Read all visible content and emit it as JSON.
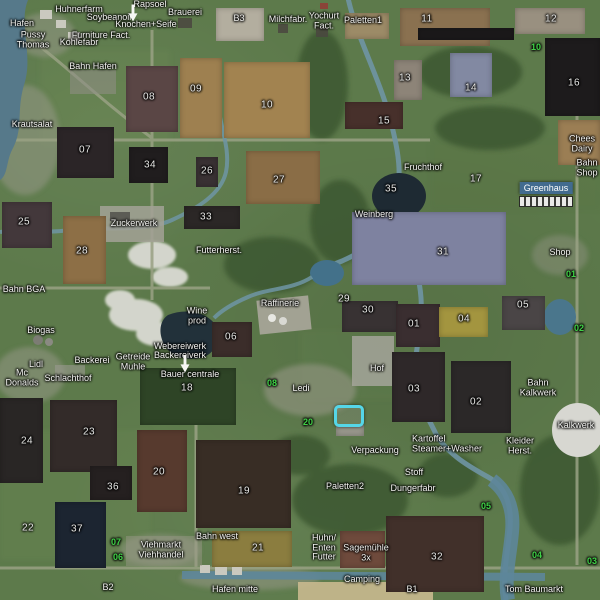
{
  "map_meta": {
    "kind": "farm-map-overview"
  },
  "colors": {
    "grass": "#5d7a4b",
    "water_river": "#6f95a4",
    "water_dark": "#1e2a33",
    "road": "#99a184",
    "label_text": "#f3f3f0",
    "green_marker": "#3fd146",
    "selection_cyan": "#55d6e8",
    "station_highlight": "#406a96"
  },
  "selected_station": {
    "label": "Greenhaus",
    "x": 546,
    "y": 188
  },
  "places": [
    {
      "name": "Huhnerfarm",
      "x": 79,
      "y": 10
    },
    {
      "name": "Rapsoel",
      "x": 150,
      "y": 5
    },
    {
      "name": "Brauerei",
      "x": 185,
      "y": 13
    },
    {
      "name": "Soybeanoil",
      "x": 109,
      "y": 18
    },
    {
      "name": "Knochen+Seife",
      "x": 146,
      "y": 25
    },
    {
      "name": "Hafen",
      "x": 22,
      "y": 24
    },
    {
      "name": "Pussy\nThomas",
      "x": 33,
      "y": 40
    },
    {
      "name": "Furniture Fact.",
      "x": 101,
      "y": 36
    },
    {
      "name": "Kohlefabr",
      "x": 79,
      "y": 43
    },
    {
      "name": "Bahn Hafen",
      "x": 93,
      "y": 67
    },
    {
      "name": "B3",
      "x": 239,
      "y": 19
    },
    {
      "name": "Milchfabr.",
      "x": 288,
      "y": 20
    },
    {
      "name": "Yochurt\nFact.",
      "x": 324,
      "y": 21
    },
    {
      "name": "Paletten1",
      "x": 363,
      "y": 21
    },
    {
      "name": "Krautsalat",
      "x": 32,
      "y": 125
    },
    {
      "name": "Fruchthof",
      "x": 423,
      "y": 168
    },
    {
      "name": "Chees\nDairy",
      "x": 582,
      "y": 144
    },
    {
      "name": "Bahn\nShop",
      "x": 587,
      "y": 168
    },
    {
      "name": "Zuckerwerk",
      "x": 134,
      "y": 224
    },
    {
      "name": "Futterherst.",
      "x": 219,
      "y": 251
    },
    {
      "name": "Weinberg",
      "x": 374,
      "y": 215
    },
    {
      "name": "Shop",
      "x": 560,
      "y": 253
    },
    {
      "name": "Bahn BGA",
      "x": 24,
      "y": 290
    },
    {
      "name": "Raffinerie",
      "x": 280,
      "y": 304
    },
    {
      "name": "Wine\nprod",
      "x": 197,
      "y": 316
    },
    {
      "name": "Biogas",
      "x": 41,
      "y": 331
    },
    {
      "name": "Webereiwerk",
      "x": 180,
      "y": 347
    },
    {
      "name": "Backereiverk",
      "x": 180,
      "y": 356
    },
    {
      "name": "Getreide\nMuhle",
      "x": 133,
      "y": 362
    },
    {
      "name": "Backerei",
      "x": 92,
      "y": 361
    },
    {
      "name": "Lidl",
      "x": 36,
      "y": 365
    },
    {
      "name": "Mc\nDonalds",
      "x": 22,
      "y": 378
    },
    {
      "name": "Schlachthof",
      "x": 68,
      "y": 379
    },
    {
      "name": "Bauer centrale",
      "x": 190,
      "y": 375
    },
    {
      "name": "Hof",
      "x": 377,
      "y": 369
    },
    {
      "name": "Ledi",
      "x": 301,
      "y": 389
    },
    {
      "name": "Bahn\nKalkwerk",
      "x": 538,
      "y": 388
    },
    {
      "name": "Kalkwerk",
      "x": 576,
      "y": 426
    },
    {
      "name": "Kartoffel\nSteamer+Washer",
      "x": 412,
      "y": 444,
      "align": "left"
    },
    {
      "name": "Kleider\nHerst.",
      "x": 520,
      "y": 446
    },
    {
      "name": "Verpackung",
      "x": 375,
      "y": 451
    },
    {
      "name": "Stoff",
      "x": 414,
      "y": 473
    },
    {
      "name": "Dungerfabr",
      "x": 413,
      "y": 489
    },
    {
      "name": "Paletten2",
      "x": 345,
      "y": 487
    },
    {
      "name": "Viehmarkt\nViehhandel",
      "x": 161,
      "y": 550
    },
    {
      "name": "Bahn west",
      "x": 217,
      "y": 537
    },
    {
      "name": "Huhn/\nEnten\nFutter",
      "x": 324,
      "y": 548
    },
    {
      "name": "Sagemühle\n3x",
      "x": 366,
      "y": 553
    },
    {
      "name": "Camping",
      "x": 362,
      "y": 580
    },
    {
      "name": "Hafen mitte",
      "x": 235,
      "y": 590
    },
    {
      "name": "Tom Baumarkt",
      "x": 534,
      "y": 590
    },
    {
      "name": "B2",
      "x": 108,
      "y": 588
    },
    {
      "name": "B1",
      "x": 412,
      "y": 590
    }
  ],
  "field_numbers": [
    {
      "label": "07",
      "x": 85,
      "y": 151
    },
    {
      "label": "08",
      "x": 149,
      "y": 98
    },
    {
      "label": "09",
      "x": 196,
      "y": 90
    },
    {
      "label": "10",
      "x": 267,
      "y": 106
    },
    {
      "label": "11",
      "x": 427,
      "y": 20
    },
    {
      "label": "12",
      "x": 551,
      "y": 20
    },
    {
      "label": "13",
      "x": 405,
      "y": 79
    },
    {
      "label": "14",
      "x": 471,
      "y": 89
    },
    {
      "label": "15",
      "x": 384,
      "y": 122
    },
    {
      "label": "16",
      "x": 574,
      "y": 84
    },
    {
      "label": "17",
      "x": 476,
      "y": 180
    },
    {
      "label": "34",
      "x": 150,
      "y": 166
    },
    {
      "label": "27",
      "x": 279,
      "y": 181
    },
    {
      "label": "26",
      "x": 207,
      "y": 172
    },
    {
      "label": "25",
      "x": 24,
      "y": 223
    },
    {
      "label": "28",
      "x": 82,
      "y": 252
    },
    {
      "label": "33",
      "x": 206,
      "y": 218
    },
    {
      "label": "35",
      "x": 391,
      "y": 190
    },
    {
      "label": "31",
      "x": 443,
      "y": 253
    },
    {
      "label": "29",
      "x": 344,
      "y": 300
    },
    {
      "label": "30",
      "x": 368,
      "y": 311
    },
    {
      "label": "01",
      "x": 414,
      "y": 325
    },
    {
      "label": "04",
      "x": 464,
      "y": 320
    },
    {
      "label": "05",
      "x": 523,
      "y": 306
    },
    {
      "label": "06",
      "x": 231,
      "y": 338
    },
    {
      "label": "18",
      "x": 187,
      "y": 389
    },
    {
      "label": "03",
      "x": 414,
      "y": 390
    },
    {
      "label": "02",
      "x": 476,
      "y": 403
    },
    {
      "label": "23",
      "x": 89,
      "y": 433
    },
    {
      "label": "24",
      "x": 27,
      "y": 442
    },
    {
      "label": "20",
      "x": 159,
      "y": 473
    },
    {
      "label": "36",
      "x": 113,
      "y": 488
    },
    {
      "label": "19",
      "x": 244,
      "y": 492
    },
    {
      "label": "22",
      "x": 28,
      "y": 529
    },
    {
      "label": "37",
      "x": 77,
      "y": 530
    },
    {
      "label": "21",
      "x": 258,
      "y": 549
    },
    {
      "label": "32",
      "x": 437,
      "y": 558
    }
  ],
  "green_numbers": [
    {
      "label": "10",
      "x": 536,
      "y": 48
    },
    {
      "label": "01",
      "x": 571,
      "y": 275
    },
    {
      "label": "02",
      "x": 579,
      "y": 329
    },
    {
      "label": "08",
      "x": 272,
      "y": 384
    },
    {
      "label": "20",
      "x": 308,
      "y": 423
    },
    {
      "label": "07",
      "x": 116,
      "y": 543
    },
    {
      "label": "06",
      "x": 118,
      "y": 558
    },
    {
      "label": "05",
      "x": 486,
      "y": 507
    },
    {
      "label": "04",
      "x": 537,
      "y": 556
    },
    {
      "label": "03",
      "x": 592,
      "y": 562
    }
  ],
  "markers": [
    {
      "type": "player-arrow",
      "x": 133,
      "y": 13
    },
    {
      "type": "player-arrow",
      "x": 185,
      "y": 364
    },
    {
      "type": "selection-target",
      "x": 349,
      "y": 416
    }
  ],
  "field_plots": [
    {
      "x": 216,
      "y": 8,
      "w": 48,
      "h": 33,
      "c": "#b3ae9f"
    },
    {
      "x": 345,
      "y": 13,
      "w": 44,
      "h": 26,
      "c": "#9c8b67"
    },
    {
      "x": 400,
      "y": 8,
      "w": 90,
      "h": 38,
      "c": "#8a7150"
    },
    {
      "x": 418,
      "y": 28,
      "w": 96,
      "h": 12,
      "c": "#1b191a"
    },
    {
      "x": 515,
      "y": 8,
      "w": 70,
      "h": 26,
      "c": "#999080"
    },
    {
      "x": 394,
      "y": 60,
      "w": 28,
      "h": 40,
      "c": "#8d8478"
    },
    {
      "x": 450,
      "y": 53,
      "w": 42,
      "h": 44,
      "c": "#8289a2"
    },
    {
      "x": 545,
      "y": 38,
      "w": 55,
      "h": 78,
      "c": "#1d1b1c"
    },
    {
      "x": 558,
      "y": 120,
      "w": 42,
      "h": 45,
      "c": "#9b7e54"
    },
    {
      "x": 345,
      "y": 102,
      "w": 58,
      "h": 27,
      "c": "#47302b"
    },
    {
      "x": 126,
      "y": 66,
      "w": 52,
      "h": 66,
      "c": "#5a4645"
    },
    {
      "x": 180,
      "y": 58,
      "w": 42,
      "h": 80,
      "c": "#9e8050"
    },
    {
      "x": 224,
      "y": 62,
      "w": 86,
      "h": 76,
      "c": "#a28350"
    },
    {
      "x": 57,
      "y": 127,
      "w": 57,
      "h": 51,
      "c": "#2b2527"
    },
    {
      "x": 129,
      "y": 147,
      "w": 39,
      "h": 36,
      "c": "#201d1e"
    },
    {
      "x": 246,
      "y": 151,
      "w": 74,
      "h": 53,
      "c": "#8a6d46"
    },
    {
      "x": 196,
      "y": 157,
      "w": 22,
      "h": 30,
      "c": "#393133"
    },
    {
      "x": 2,
      "y": 202,
      "w": 50,
      "h": 46,
      "c": "#43383b"
    },
    {
      "x": 63,
      "y": 216,
      "w": 43,
      "h": 68,
      "c": "#8d6f46"
    },
    {
      "x": 184,
      "y": 206,
      "w": 56,
      "h": 23,
      "c": "#2b2726"
    },
    {
      "x": 352,
      "y": 212,
      "w": 154,
      "h": 73,
      "c": "#7e82a0"
    },
    {
      "x": 342,
      "y": 301,
      "w": 56,
      "h": 31,
      "c": "#383233"
    },
    {
      "x": 396,
      "y": 304,
      "w": 44,
      "h": 43,
      "c": "#3a2e30"
    },
    {
      "x": 439,
      "y": 307,
      "w": 49,
      "h": 30,
      "c": "#a3953f"
    },
    {
      "x": 502,
      "y": 296,
      "w": 43,
      "h": 34,
      "c": "#4a4546"
    },
    {
      "x": 212,
      "y": 322,
      "w": 40,
      "h": 35,
      "c": "#3b2d2a"
    },
    {
      "x": 140,
      "y": 368,
      "w": 96,
      "h": 57,
      "c": "#2e4426"
    },
    {
      "x": 392,
      "y": 352,
      "w": 53,
      "h": 70,
      "c": "#2e2829"
    },
    {
      "x": 451,
      "y": 361,
      "w": 60,
      "h": 72,
      "c": "#2b2828"
    },
    {
      "x": 50,
      "y": 400,
      "w": 67,
      "h": 72,
      "c": "#332b29"
    },
    {
      "x": 0,
      "y": 398,
      "w": 43,
      "h": 85,
      "c": "#292625"
    },
    {
      "x": 137,
      "y": 430,
      "w": 50,
      "h": 82,
      "c": "#573a2e"
    },
    {
      "x": 90,
      "y": 466,
      "w": 42,
      "h": 34,
      "c": "#252020"
    },
    {
      "x": 196,
      "y": 440,
      "w": 95,
      "h": 88,
      "c": "#382d25"
    },
    {
      "x": 55,
      "y": 502,
      "w": 51,
      "h": 66,
      "c": "#1c2531"
    },
    {
      "x": 212,
      "y": 531,
      "w": 80,
      "h": 36,
      "c": "#8b7d3f"
    },
    {
      "x": 386,
      "y": 516,
      "w": 98,
      "h": 76,
      "c": "#41302a"
    },
    {
      "x": 340,
      "y": 531,
      "w": 45,
      "h": 37,
      "c": "#6e4a3c"
    },
    {
      "x": 336,
      "y": 425,
      "w": 28,
      "h": 11,
      "c": "#98978c"
    }
  ]
}
